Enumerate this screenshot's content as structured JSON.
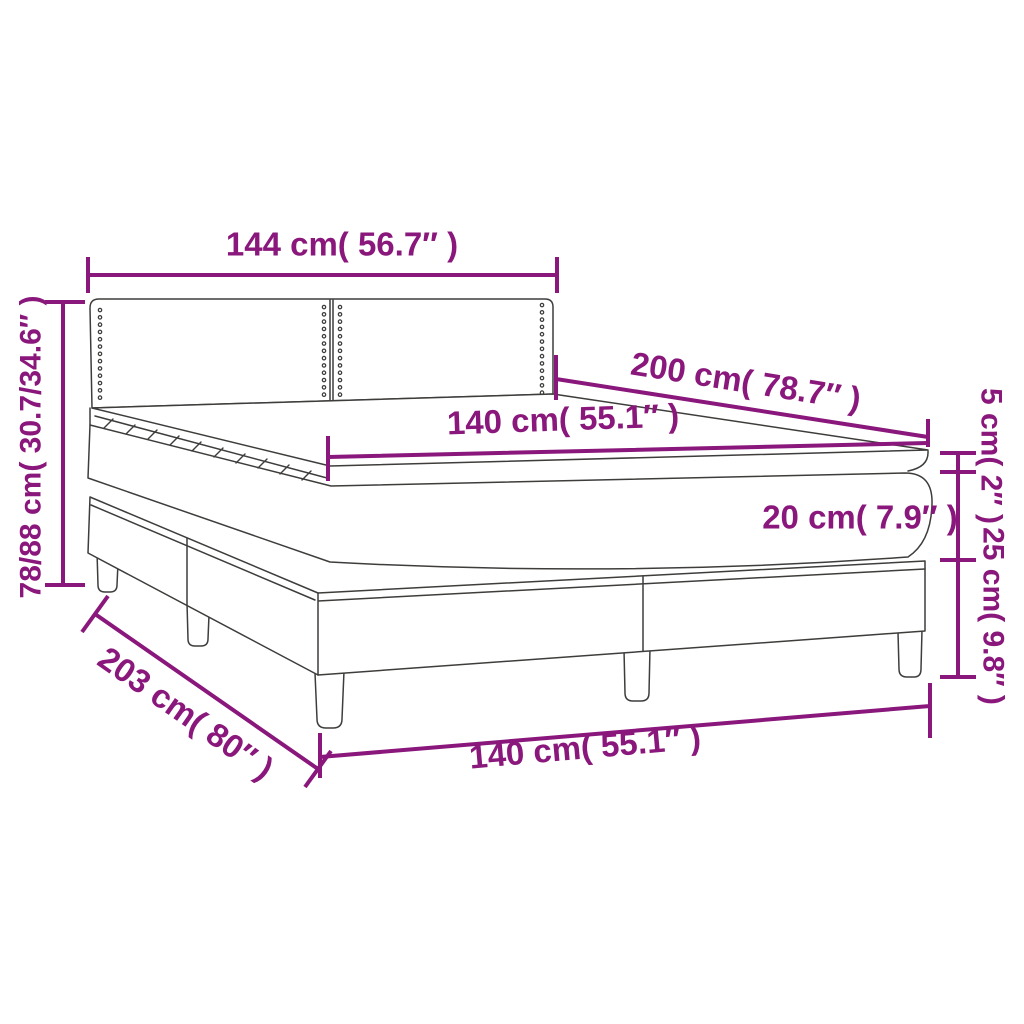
{
  "colors": {
    "dimension": "#8a177b",
    "line": "#3e3d3b",
    "background": "#ffffff"
  },
  "labels": {
    "headboard_width": "144 cm( 56.7″ )",
    "mattress_length": "200 cm( 78.7″ )",
    "mattress_width_top": "140 cm( 55.1″ )",
    "total_height": "78/88 cm( 30.7/34.6″ )",
    "topper_height": "5 cm( 2″ )",
    "mattress_height": "20 cm( 7.9″ )",
    "base_height": "25 cm( 9.8″ )",
    "total_length": "203 cm( 80″ )",
    "mattress_width_front": "140 cm( 55.1″ )"
  }
}
